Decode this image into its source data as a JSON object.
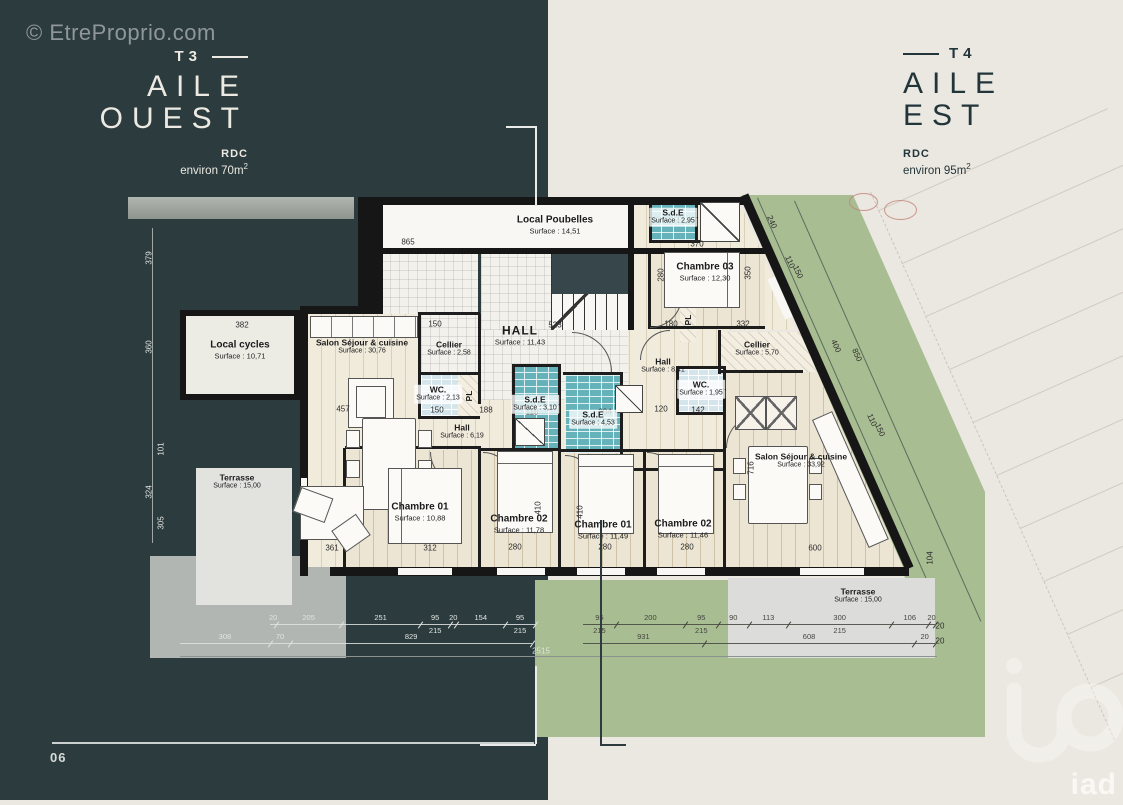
{
  "watermark": "© EtreProprio.com",
  "footer": {
    "page_number": "06"
  },
  "brand": {
    "logo_text": "iad"
  },
  "west_panel": {
    "tag": "T3",
    "title1": "AILE",
    "title2": "OUEST",
    "floor": "RDC",
    "area_prefix": "environ 70m",
    "area_exp": "2"
  },
  "east_panel": {
    "tag": "T4",
    "title1": "AILE",
    "title2": "EST",
    "floor": "RDC",
    "area_prefix": "environ 95m",
    "area_exp": "2"
  },
  "rooms": {
    "local_poubelles": {
      "name": "Local Poubelles",
      "surface": "Surface : 14,51"
    },
    "sde_nord": {
      "name": "S.d.E",
      "surface": "Surface : 2,95"
    },
    "chambre03": {
      "name": "Chambre 03",
      "surface": "Surface : 12,30"
    },
    "local_cycles": {
      "name": "Local cycles",
      "surface": "Surface : 10,71"
    },
    "salon_ouest": {
      "name": "Salon Séjour & cuisine",
      "surface": "Surface : 30,76"
    },
    "cellier_ouest": {
      "name": "Cellier",
      "surface": "Surface : 2,58"
    },
    "wc_ouest": {
      "name": "WC.",
      "surface": "Surface : 2,13"
    },
    "hall_principal": {
      "name": "HALL",
      "surface": "Surface : 11,43"
    },
    "hall_ouest": {
      "name": "Hall",
      "surface": "Surface : 6,19"
    },
    "sde_ouest": {
      "name": "S.d.E",
      "surface": "Surface : 3,10"
    },
    "chambre01_ouest": {
      "name": "Chambre 01",
      "surface": "Surface : 10,88"
    },
    "chambre02_ouest": {
      "name": "Chambre 02",
      "surface": "Surface : 11,78"
    },
    "terrasse_ouest": {
      "name": "Terrasse",
      "surface": "Surface : 15,00"
    },
    "hall_est": {
      "name": "Hall",
      "surface": "Surface : 8,41"
    },
    "cellier_est": {
      "name": "Cellier",
      "surface": "Surface : 5,70"
    },
    "wc_est": {
      "name": "WC.",
      "surface": "Surface : 1,95"
    },
    "sde_est": {
      "name": "S.d.E",
      "surface": "Surface : 4,53"
    },
    "chambre01_est": {
      "name": "Chambre 01",
      "surface": "Surface : 11,49"
    },
    "chambre02_est": {
      "name": "Chambre 02",
      "surface": "Surface : 11,46"
    },
    "salon_est": {
      "name": "Salon Séjour & cuisine",
      "surface": "Surface : 33,92"
    },
    "terrasse_est": {
      "name": "Terrasse",
      "surface": "Surface : 15,00"
    },
    "pl_ouest": {
      "name": "PL"
    },
    "pl_est": {
      "name": "PL"
    }
  },
  "chains": {
    "west1": [
      "20",
      "205",
      "251",
      "95",
      "20",
      "154",
      "95"
    ],
    "west1_sub": "215",
    "west2": [
      "308",
      "70",
      "829"
    ],
    "total": "2515",
    "east1": [
      "95",
      "200",
      "95",
      "90",
      "113",
      "300",
      "106",
      "20"
    ],
    "east1_sub": "215",
    "east2": [
      "931",
      "608",
      "20"
    ],
    "east3": "20"
  },
  "pdims": {
    "d865": "865",
    "d523": "523",
    "d370": "370",
    "d382": "382",
    "d457": "457",
    "d150a": "150",
    "d150b": "150",
    "d188": "188",
    "d118": "118",
    "d204": "204",
    "d120": "120",
    "d142": "142",
    "d180": "180",
    "d332": "332",
    "d361": "361",
    "d312": "312",
    "d280a": "280",
    "d280b": "280",
    "d280c": "280",
    "d600": "600",
    "d716": "716",
    "d104": "104",
    "d350": "350",
    "d280d": "280",
    "d410a": "410",
    "d410b": "410",
    "d379": "379",
    "d360": "360",
    "d101": "101",
    "d324": "324",
    "d305": "305",
    "d240": "240",
    "d110a": "110",
    "d150c": "150",
    "d400": "400",
    "d850": "850",
    "d110b": "110",
    "d150d": "150"
  }
}
